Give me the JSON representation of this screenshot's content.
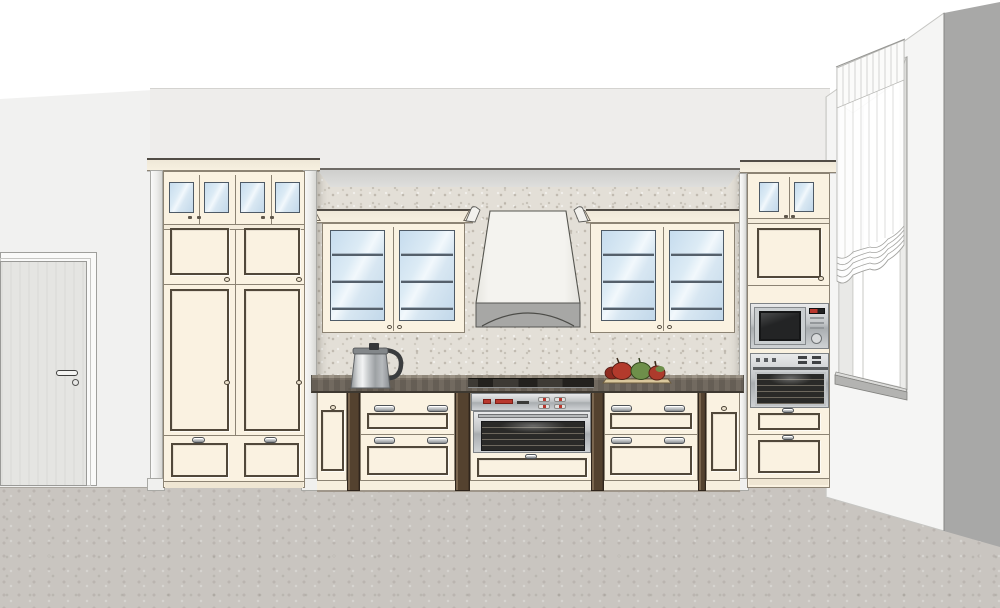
{
  "viewport": {
    "label": "3D kitchen elevation render",
    "width_px": 1000,
    "height_px": 608
  },
  "palette": {
    "wall-back": "#eeedeb",
    "wall-left": "#f1f1f0",
    "wall-right": "#f5f5f4",
    "wall-edge": "#a8a8a7",
    "floor": "#c9c5c0",
    "backsplash": "#e3dfd7",
    "soffit": "#d8d8d6",
    "cream": "#faf2e1",
    "cream-outline": "#8c8373",
    "panel-outline": "#51483a",
    "cornice": "#efe8d8",
    "glass-blue": "#cfe3f2",
    "shelf": "#55606b",
    "counter-top": "#9a9183",
    "counter-face": "#6d655b",
    "wood-post": "#54422f",
    "plinth": "#f7efde",
    "hood-body": "#f2f1ed",
    "hood-band": "#a7a7a5",
    "steel-a": "#e9eaeb",
    "steel-b": "#cfd2d4",
    "appliance-glass": "#2a2a28",
    "accent-red": "#b9382e",
    "door-gray": "#e5e5e2",
    "pillar": "#f6f6f5",
    "curtain": "#ffffff",
    "fruit-red": "#b33a2c",
    "fruit-green": "#6e8f4a",
    "tray": "#d9c79c",
    "kettle": "#e8eaeb"
  },
  "scene": {
    "room": {
      "label": "Kitchen room corner view"
    },
    "objects": {
      "door": {
        "label": "Interior door"
      },
      "window": {
        "label": "Window"
      },
      "curtain": {
        "label": "Sheer roman curtain"
      },
      "tall_cabinet_left": {
        "label": "Tall pantry cabinet with glass top doors"
      },
      "tall_cabinet_right": {
        "label": "Tall appliance cabinet"
      },
      "wall_cabinet_left": {
        "label": "Glass-door wall cabinet"
      },
      "wall_cabinet_right": {
        "label": "Glass-door wall cabinet"
      },
      "hood": {
        "label": "Chimney range hood"
      },
      "microwave": {
        "label": "Built-in microwave"
      },
      "wall_oven": {
        "label": "Built-in oven"
      },
      "range_oven": {
        "label": "Under-counter oven with cooktop"
      },
      "base_drawers_left": {
        "label": "Base drawer unit"
      },
      "base_drawers_right": {
        "label": "Base drawer unit"
      },
      "base_door_left": {
        "label": "Narrow base cabinet"
      },
      "base_door_right": {
        "label": "Narrow base cabinet"
      },
      "countertop": {
        "label": "Dark wood countertop"
      },
      "backsplash": {
        "label": "Mosaic backsplash"
      },
      "kettle": {
        "label": "Electric kettle"
      },
      "fruit_plate": {
        "label": "Tray with fruit"
      }
    }
  }
}
